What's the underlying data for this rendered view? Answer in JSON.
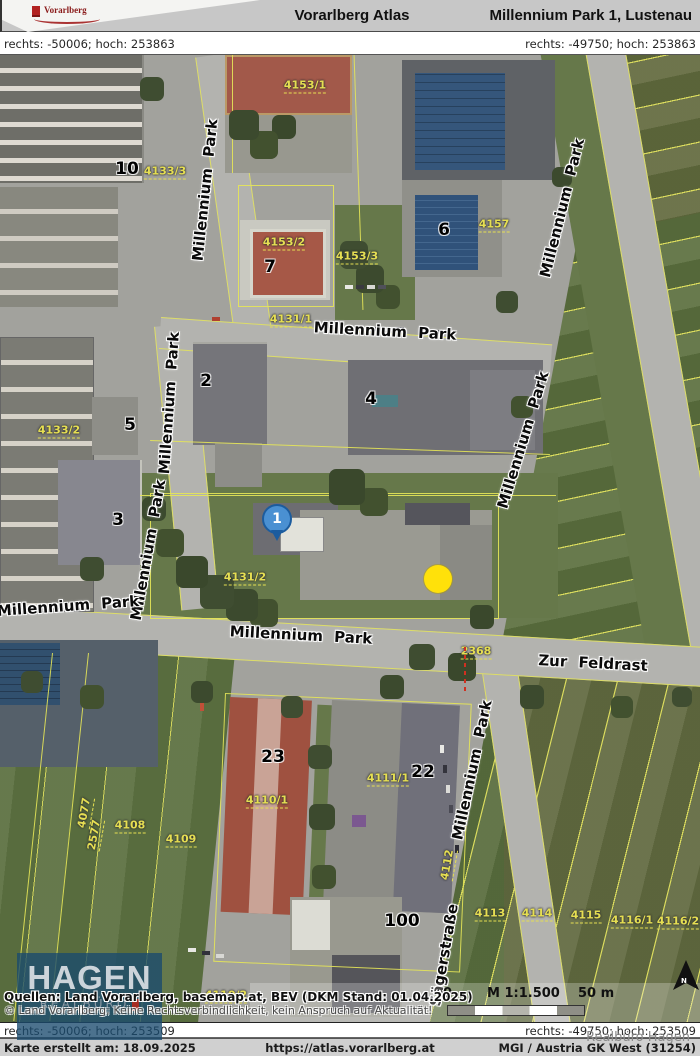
{
  "header": {
    "logo_text": "Vorarlberg",
    "app_title": "Vorarlberg Atlas",
    "location_title": "Millennium Park 1, Lustenau"
  },
  "coords": {
    "top_left": "rechts: -50006; hoch: 253863",
    "top_right": "rechts: -49750; hoch: 253863",
    "bottom_left": "rechts: -50006; hoch: 253509",
    "bottom_right": "rechts: -49750; hoch: 253509"
  },
  "map": {
    "street_labels": [
      {
        "text": "Millennium Park",
        "x": 205,
        "y": 135,
        "rot": -84
      },
      {
        "text": "Millennium Park",
        "x": 169,
        "y": 348,
        "rot": -86
      },
      {
        "text": "Millennium Park",
        "x": 148,
        "y": 495,
        "rot": -80
      },
      {
        "text": "Millennium Park",
        "x": 385,
        "y": 276,
        "rot": 3
      },
      {
        "text": "Millennium Park",
        "x": 562,
        "y": 153,
        "rot": -76
      },
      {
        "text": "Millennium Park",
        "x": 523,
        "y": 385,
        "rot": -73
      },
      {
        "text": "Millennium Park",
        "x": 68,
        "y": 551,
        "rot": -4
      },
      {
        "text": "Millennium Park",
        "x": 301,
        "y": 580,
        "rot": 3
      },
      {
        "text": "Millennium Park",
        "x": 472,
        "y": 715,
        "rot": -78
      },
      {
        "text": "Zur Feldrast",
        "x": 593,
        "y": 608,
        "rot": 3
      },
      {
        "text": "Sägerstraße",
        "x": 444,
        "y": 900,
        "rot": -80
      }
    ],
    "building_numbers": [
      {
        "text": "10",
        "x": 127,
        "y": 114
      },
      {
        "text": "7",
        "x": 270,
        "y": 212
      },
      {
        "text": "6",
        "x": 444,
        "y": 175
      },
      {
        "text": "2",
        "x": 206,
        "y": 326
      },
      {
        "text": "4",
        "x": 371,
        "y": 344
      },
      {
        "text": "5",
        "x": 130,
        "y": 370
      },
      {
        "text": "3",
        "x": 118,
        "y": 465
      },
      {
        "text": "23",
        "x": 273,
        "y": 702
      },
      {
        "text": "22",
        "x": 423,
        "y": 717
      },
      {
        "text": "100",
        "x": 402,
        "y": 866
      }
    ],
    "parcel_labels": [
      {
        "text": "4153/1",
        "x": 305,
        "y": 31,
        "rot": 0
      },
      {
        "text": "4133/3",
        "x": 165,
        "y": 117,
        "rot": 0
      },
      {
        "text": "4153/2",
        "x": 284,
        "y": 188,
        "rot": 0
      },
      {
        "text": "4157",
        "x": 494,
        "y": 170,
        "rot": 0
      },
      {
        "text": "4153/3",
        "x": 357,
        "y": 202,
        "rot": 0
      },
      {
        "text": "4131/1",
        "x": 291,
        "y": 265,
        "rot": 0
      },
      {
        "text": "4133/2",
        "x": 59,
        "y": 376,
        "rot": 0
      },
      {
        "text": "4131/2",
        "x": 245,
        "y": 523,
        "rot": 0
      },
      {
        "text": "2368",
        "x": 476,
        "y": 597,
        "rot": 0
      },
      {
        "text": "4108",
        "x": 130,
        "y": 771,
        "rot": 0
      },
      {
        "text": "4109",
        "x": 181,
        "y": 785,
        "rot": 0
      },
      {
        "text": "4110/1",
        "x": 267,
        "y": 746,
        "rot": 0
      },
      {
        "text": "4111/1",
        "x": 388,
        "y": 724,
        "rot": 0
      },
      {
        "text": "4112",
        "x": 448,
        "y": 810,
        "rot": -80
      },
      {
        "text": "2577",
        "x": 95,
        "y": 780,
        "rot": -80
      },
      {
        "text": "4077",
        "x": 85,
        "y": 758,
        "rot": -80
      },
      {
        "text": "4110/2",
        "x": 226,
        "y": 941,
        "rot": 0
      },
      {
        "text": "4113",
        "x": 490,
        "y": 859,
        "rot": 0
      },
      {
        "text": "4114",
        "x": 537,
        "y": 859,
        "rot": 0
      },
      {
        "text": "4115",
        "x": 586,
        "y": 861,
        "rot": 0
      },
      {
        "text": "4116/1",
        "x": 632,
        "y": 866,
        "rot": 0
      },
      {
        "text": "4116/2",
        "x": 678,
        "y": 867,
        "rot": 0
      }
    ],
    "pin_label": "1",
    "north_label": "N",
    "scale": {
      "zero": "0",
      "ratio": "M 1:1.500",
      "distance": "50 m"
    },
    "attribution": {
      "line1": "Quellen: Land Vorarlberg, basemap.at, BEV (DKM Stand: 01.04.2025)",
      "line2": "© Land Vorarlberg; Keine Rechtsverbindlichkeit, kein Anspruch auf Aktualität!"
    }
  },
  "logo_overlay": {
    "name": "HAGEN",
    "sub": "REALBÜRO"
  },
  "footer": {
    "created": "Karte erstellt am: 18.09.2025",
    "url": "https://atlas.vorarlberg.at",
    "crs": "MGI / Austria GK West (31254)",
    "watermark": "Realbüro Hagen"
  },
  "colors": {
    "pin_blue": "#4a90d2",
    "marker_yellow": "#ffe10a",
    "parcel_yellow": "#e6df52",
    "header_gray": "#c7c7c7"
  }
}
